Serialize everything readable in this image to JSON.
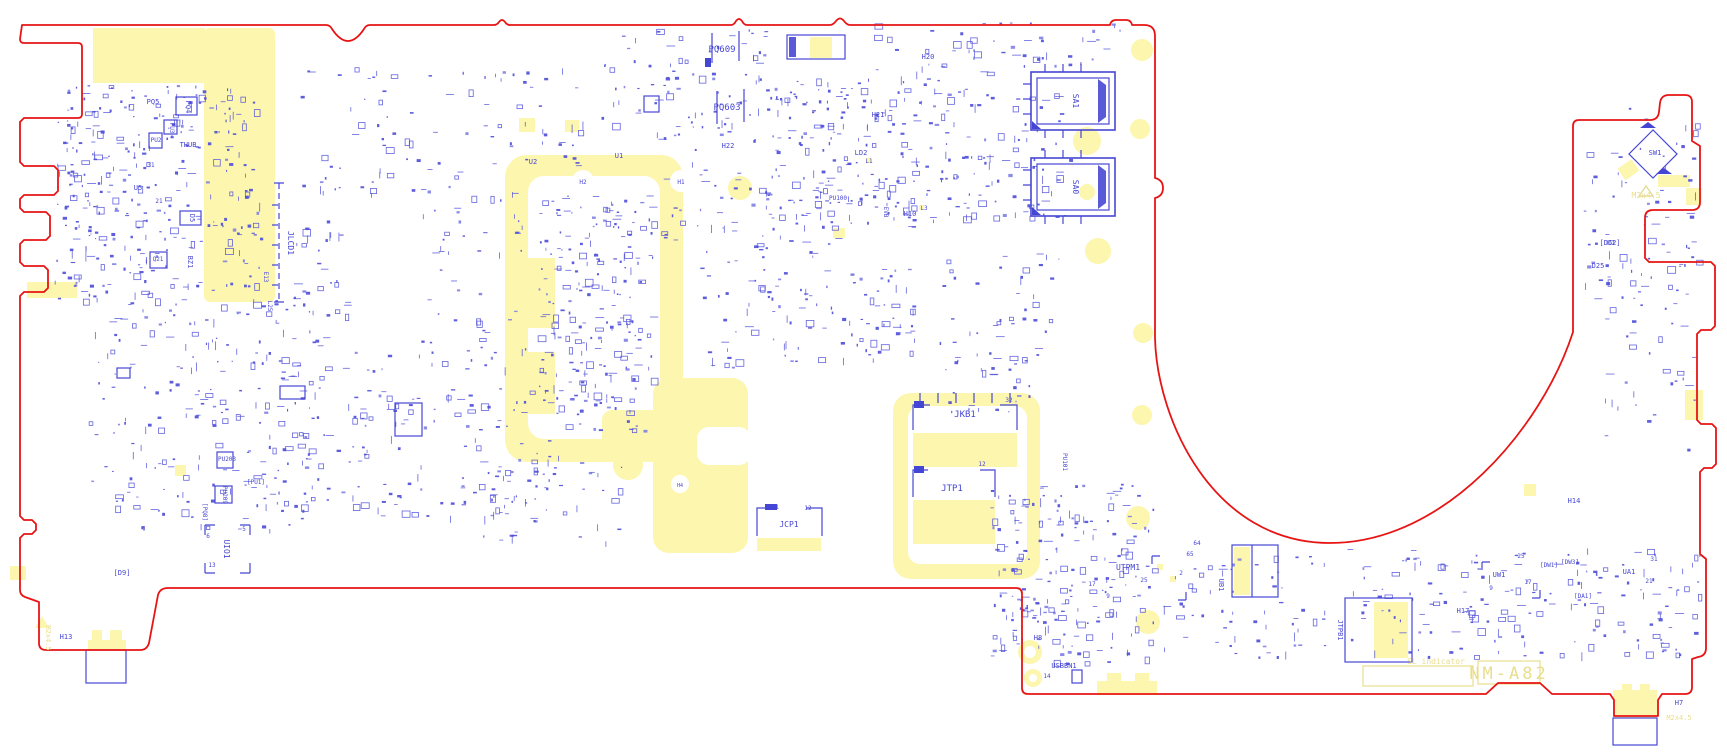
{
  "drawing": {
    "type": "pcb-assembly-drawing",
    "palette": {
      "board_outline": "#e81414",
      "silkscreen_blue": "#4646d4",
      "copper_yellow": "#fcf6ae",
      "yellow_text": "#e9de8e",
      "background": "#ffffff"
    }
  },
  "labels": [
    {
      "t": "PQ5",
      "x": 153,
      "y": 104,
      "r": 0,
      "s": 7
    },
    {
      "t": "PQ4",
      "x": 186,
      "y": 107,
      "r": 90,
      "s": 7
    },
    {
      "t": "PU3",
      "x": 170,
      "y": 128,
      "r": 90,
      "s": 6
    },
    {
      "t": "PU2",
      "x": 156,
      "y": 142,
      "r": 0,
      "s": 6
    },
    {
      "t": "THUB",
      "x": 188,
      "y": 147,
      "r": 0,
      "s": 7
    },
    {
      "t": "U5",
      "x": 138,
      "y": 190,
      "r": 0,
      "s": 7
    },
    {
      "t": "21",
      "x": 159,
      "y": 203,
      "r": 0,
      "s": 6
    },
    {
      "t": "31",
      "x": 151,
      "y": 167,
      "r": 0,
      "s": 6
    },
    {
      "t": "D5",
      "x": 190,
      "y": 218,
      "r": 90,
      "s": 7
    },
    {
      "t": "Q21",
      "x": 158,
      "y": 261,
      "r": 0,
      "s": 6
    },
    {
      "t": "BZ1",
      "x": 188,
      "y": 262,
      "r": 90,
      "s": 7
    },
    {
      "t": "E13",
      "x": 264,
      "y": 277,
      "r": 90,
      "s": 6
    },
    {
      "t": "L25",
      "x": 268,
      "y": 306,
      "r": 90,
      "s": 6
    },
    {
      "t": "JLCD1",
      "x": 288,
      "y": 243,
      "r": 90,
      "s": 8
    },
    {
      "t": "PU203",
      "x": 227,
      "y": 461,
      "r": 0,
      "s": 6
    },
    {
      "t": "[PU1]",
      "x": 256,
      "y": 484,
      "r": 0,
      "s": 6
    },
    {
      "t": "PU209",
      "x": 223,
      "y": 495,
      "r": 90,
      "s": 6
    },
    {
      "t": "[PQ8]",
      "x": 203,
      "y": 512,
      "r": 90,
      "s": 6
    },
    {
      "t": "UIO1",
      "x": 224,
      "y": 549,
      "r": 90,
      "s": 8
    },
    {
      "t": "5",
      "x": 244,
      "y": 531,
      "r": 0,
      "s": 6
    },
    {
      "t": "6",
      "x": 208,
      "y": 538,
      "r": 0,
      "s": 6
    },
    {
      "t": "13",
      "x": 212,
      "y": 567,
      "r": 0,
      "s": 6
    },
    {
      "t": "[D9]",
      "x": 122,
      "y": 575,
      "r": 0,
      "s": 7
    },
    {
      "t": "H13",
      "x": 66,
      "y": 639,
      "r": 0,
      "s": 7
    },
    {
      "t": "M2x4.5",
      "x": 46,
      "y": 638,
      "r": 90,
      "s": 7,
      "c": "y"
    },
    {
      "t": "PQ609",
      "x": 722,
      "y": 52,
      "r": 0,
      "s": 9
    },
    {
      "t": "PQ603",
      "x": 727,
      "y": 110,
      "r": 0,
      "s": 9
    },
    {
      "t": "H22",
      "x": 728,
      "y": 148,
      "r": 0,
      "s": 7
    },
    {
      "t": "U2",
      "x": 533,
      "y": 164,
      "r": 0,
      "s": 7
    },
    {
      "t": "U1",
      "x": 619,
      "y": 158,
      "r": 0,
      "s": 7
    },
    {
      "t": "H2",
      "x": 583,
      "y": 184,
      "r": 0,
      "s": 6
    },
    {
      "t": "H1",
      "x": 681,
      "y": 184,
      "r": 0,
      "s": 6
    },
    {
      "t": "H21",
      "x": 878,
      "y": 117,
      "r": 0,
      "s": 7
    },
    {
      "t": "H20",
      "x": 928,
      "y": 59,
      "r": 0,
      "s": 7
    },
    {
      "t": "H10",
      "x": 910,
      "y": 216,
      "r": 0,
      "s": 7
    },
    {
      "t": "LD2",
      "x": 861,
      "y": 155,
      "r": 0,
      "s": 7
    },
    {
      "t": "L1",
      "x": 869,
      "y": 163,
      "r": 0,
      "s": 6
    },
    {
      "t": "PU100",
      "x": 838,
      "y": 200,
      "r": 0,
      "s": 6
    },
    {
      "t": "EVB",
      "x": 884,
      "y": 212,
      "r": 90,
      "s": 6
    },
    {
      "t": "L3",
      "x": 924,
      "y": 210,
      "r": 0,
      "s": 6
    },
    {
      "t": "PU101",
      "x": 1063,
      "y": 462,
      "r": 90,
      "s": 6
    },
    {
      "t": "SA1",
      "x": 1073,
      "y": 101,
      "r": 90,
      "s": 8
    },
    {
      "t": "SA0",
      "x": 1073,
      "y": 187,
      "r": 90,
      "s": 8
    },
    {
      "t": "JKB1",
      "x": 965,
      "y": 417,
      "r": 0,
      "s": 9
    },
    {
      "t": "32",
      "x": 1009,
      "y": 402,
      "r": 0,
      "s": 6
    },
    {
      "t": "JTP1",
      "x": 952,
      "y": 491,
      "r": 0,
      "s": 9
    },
    {
      "t": "12",
      "x": 982,
      "y": 466,
      "r": 0,
      "s": 6
    },
    {
      "t": "JCP1",
      "x": 789,
      "y": 527,
      "r": 0,
      "s": 8
    },
    {
      "t": "1",
      "x": 777,
      "y": 509,
      "r": 0,
      "s": 6
    },
    {
      "t": "12",
      "x": 808,
      "y": 510,
      "r": 0,
      "s": 6
    },
    {
      "t": "UTPM1",
      "x": 1128,
      "y": 570,
      "r": 0,
      "s": 8
    },
    {
      "t": "17",
      "x": 1092,
      "y": 586,
      "r": 0,
      "s": 6
    },
    {
      "t": "25",
      "x": 1144,
      "y": 582,
      "r": 0,
      "s": 6
    },
    {
      "t": "2",
      "x": 1181,
      "y": 575,
      "r": 0,
      "s": 6
    },
    {
      "t": "9",
      "x": 1108,
      "y": 598,
      "r": 0,
      "s": 6
    },
    {
      "t": "65",
      "x": 1190,
      "y": 556,
      "r": 0,
      "s": 6
    },
    {
      "t": "64",
      "x": 1197,
      "y": 545,
      "r": 0,
      "s": 6
    },
    {
      "t": "H8",
      "x": 1038,
      "y": 640,
      "r": 0,
      "s": 7
    },
    {
      "t": "USBBN1",
      "x": 1064,
      "y": 668,
      "r": 0,
      "s": 7
    },
    {
      "t": "14",
      "x": 1047,
      "y": 678,
      "r": 0,
      "s": 6
    },
    {
      "t": "UB1",
      "x": 1219,
      "y": 585,
      "r": 90,
      "s": 7
    },
    {
      "t": "JTPB1",
      "x": 1338,
      "y": 630,
      "r": 90,
      "s": 7
    },
    {
      "t": "H4",
      "x": 680,
      "y": 487,
      "r": 0,
      "s": 5
    },
    {
      "t": "H14",
      "x": 1574,
      "y": 503,
      "r": 0,
      "s": 7
    },
    {
      "t": "UW1",
      "x": 1499,
      "y": 577,
      "r": 0,
      "s": 7
    },
    {
      "t": "25",
      "x": 1521,
      "y": 558,
      "r": 0,
      "s": 6
    },
    {
      "t": "17",
      "x": 1528,
      "y": 584,
      "r": 0,
      "s": 6
    },
    {
      "t": "9",
      "x": 1491,
      "y": 590,
      "r": 0,
      "s": 6
    },
    {
      "t": "[DW1]",
      "x": 1549,
      "y": 567,
      "r": 0,
      "s": 6
    },
    {
      "t": "[DW3]",
      "x": 1570,
      "y": 564,
      "r": 0,
      "s": 6
    },
    {
      "t": "[DA1]",
      "x": 1583,
      "y": 598,
      "r": 0,
      "s": 6
    },
    {
      "t": "UA1",
      "x": 1629,
      "y": 574,
      "r": 0,
      "s": 7
    },
    {
      "t": "31",
      "x": 1654,
      "y": 561,
      "r": 0,
      "s": 6
    },
    {
      "t": "21",
      "x": 1649,
      "y": 583,
      "r": 0,
      "s": 6
    },
    {
      "t": "H17",
      "x": 1463,
      "y": 613,
      "r": 0,
      "s": 7
    },
    {
      "t": "H7",
      "x": 1679,
      "y": 705,
      "r": 0,
      "s": 7
    },
    {
      "t": "M2x4.5",
      "x": 1679,
      "y": 720,
      "r": 0,
      "s": 7,
      "c": "y"
    },
    {
      "t": "NM-A82",
      "x": 1509,
      "y": 679,
      "r": 0,
      "s": 17,
      "c": "y"
    },
    {
      "t": "SL indicator",
      "x": 1436,
      "y": 664,
      "r": 0,
      "s": 8,
      "c": "y"
    },
    {
      "t": "SW1",
      "x": 1655,
      "y": 155,
      "r": 0,
      "s": 7
    },
    {
      "t": "M2x4.5",
      "x": 1646,
      "y": 198,
      "r": 0,
      "s": 8,
      "c": "y"
    },
    {
      "t": "[D62]",
      "x": 1610,
      "y": 245,
      "r": 0,
      "s": 7
    },
    {
      "t": "D25",
      "x": 1598,
      "y": 268,
      "r": 0,
      "s": 7
    }
  ]
}
